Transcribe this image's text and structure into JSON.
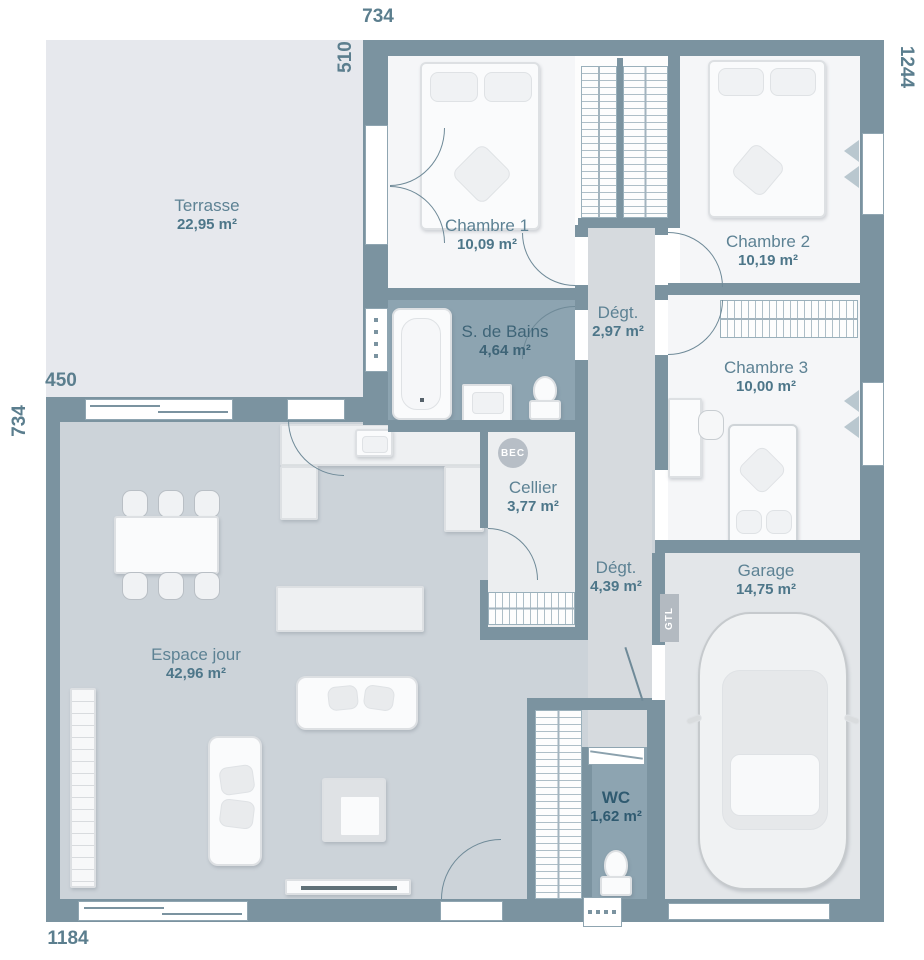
{
  "plan": {
    "title": "Plan de maison",
    "rooms": {
      "terrasse": {
        "name": "Terrasse",
        "area": "22,95 m²"
      },
      "chambre1": {
        "name": "Chambre 1",
        "area": "10,09 m²"
      },
      "chambre2": {
        "name": "Chambre 2",
        "area": "10,19 m²"
      },
      "sdb": {
        "name": "S. de Bains",
        "area": "4,64 m²"
      },
      "degt1": {
        "name": "Dégt.",
        "area": "2,97 m²"
      },
      "chambre3": {
        "name": "Chambre 3",
        "area": "10,00 m²"
      },
      "cellier": {
        "name": "Cellier",
        "area": "3,77 m²"
      },
      "degt2": {
        "name": "Dégt.",
        "area": "4,39 m²"
      },
      "espace_jour": {
        "name": "Espace jour",
        "area": "42,96 m²"
      },
      "garage": {
        "name": "Garage",
        "area": "14,75 m²"
      },
      "wc": {
        "name": "WC",
        "area": "1,62 m²"
      }
    },
    "dimensions": {
      "top": "734",
      "terrace_left_height": "510",
      "right": "1244",
      "terrace_left_width": "450",
      "left": "734",
      "bottom": "1184"
    },
    "markers": {
      "bec": "BEC",
      "gtl": "GTL"
    },
    "colors": {
      "wall": "#7b93a0",
      "floor_room": "#f5f6f8",
      "floor_living": "#ccd3d9",
      "floor_wet": "#8da4b1",
      "floor_terrace": "#e6e8ed",
      "floor_garage": "#e3e6e9",
      "floor_corridor": "#d6dade",
      "floor_cellier": "#eceef0",
      "label_text": "#5d8294"
    }
  }
}
